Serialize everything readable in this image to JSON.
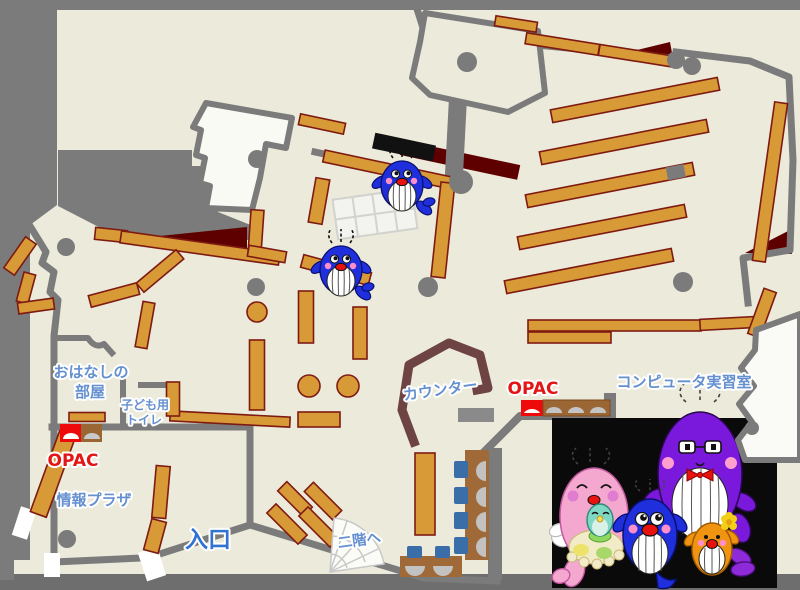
{
  "map": {
    "description": "library-first-floor-map",
    "labels": {
      "story_room_line1": "おはなしの",
      "story_room_line2": "部屋",
      "kids_toilet_line1": "子ども用",
      "kids_toilet_line2": "トイレ",
      "opac_left": "OPAC",
      "opac_center": "OPAC",
      "info_plaza": "情報プラザ",
      "entrance": "入口",
      "to_second_floor": "二階へ",
      "counter": "カウンター",
      "computer_room": "コンピュータ実習室"
    },
    "colors": {
      "floor": "#ECEADB",
      "wall_gray": "#7B7B7B",
      "shelf_orange": "#D89A36",
      "shelf_border": "#7E1A12",
      "dark_red": "#5E0000",
      "counter_brown": "#6E4343",
      "label_blue": "#6490CF",
      "entrance_blue": "#3273D2",
      "opac_red": "#E31515",
      "chair_blue": "#3A6EA8",
      "desk_brown": "#A06A38",
      "mascot_blue": "#1F2FDC",
      "mascot_pink": "#F4A8CF",
      "mascot_purple": "#7A18DC",
      "mascot_orange": "#F09310",
      "mascot_baby_teal": "#7ED8C4"
    },
    "mascots": [
      "blue-whale-on-shelf-1",
      "blue-whale-on-shelf-2",
      "pink-whale-mother",
      "baby-whale",
      "blue-whale-child",
      "purple-whale-father",
      "orange-whale-child"
    ]
  }
}
